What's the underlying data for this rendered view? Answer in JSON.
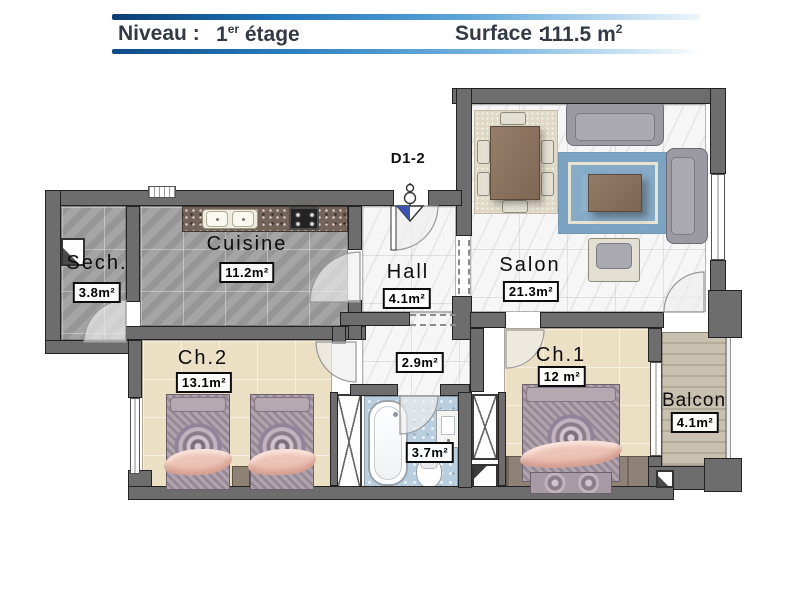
{
  "header": {
    "level_label": "Niveau :",
    "level_number": "1",
    "level_ordinal": "er",
    "level_word": " étage",
    "surface_label": "Surface :",
    "surface_number": "111.5 m",
    "surface_exp": "2"
  },
  "plan": {
    "entrance_door_label": "D1-2",
    "rooms": {
      "cuisine": {
        "name": "Cuisine",
        "area": "11.2m²"
      },
      "hall": {
        "name": "Hall",
        "area": "4.1m²"
      },
      "salon": {
        "name": "Salon",
        "area": "21.3m²"
      },
      "sech": {
        "name": "Sech.",
        "area": "3.8m²"
      },
      "ch2": {
        "name": "Ch.2",
        "area": "13.1m²"
      },
      "ch1": {
        "name": "Ch.1",
        "area": "12 m²"
      },
      "balcon": {
        "name": "Balcon",
        "area": "4.1m²"
      },
      "degagement": {
        "area": "2.9m²"
      },
      "salle_de_bain": {
        "area": "3.7m²"
      }
    }
  },
  "colors": {
    "accent_blue": "#1565ad",
    "header_text_dark": "#333a45",
    "wall_gray": "#6d6d6d",
    "tile_gray": "#a3a3a3",
    "bedroom_beige": "#ebdfc4",
    "bath_blue": "#b9cede",
    "balcony_tan": "#c9c1b0",
    "bed_pink": "#edc5b8",
    "rug_blue": "#8fb2cc"
  }
}
